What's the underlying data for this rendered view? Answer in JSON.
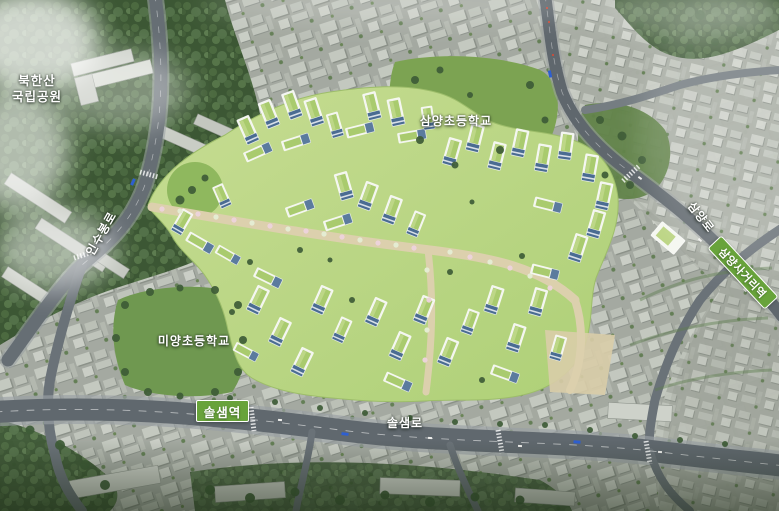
{
  "palette": {
    "label_white": "#ffffff",
    "badge_green": "#68a33b",
    "badge_border": "#ffffff",
    "road_grey": "#60686e",
    "forest_green": "#3f5a37",
    "field_green": "#7ca352",
    "city_grey": "#a9aea6",
    "dev_lawn": "#b9d383",
    "building_white": "#f3f5ef",
    "roof_green": "#a9cb6e",
    "glass_blue": "#4a6c92",
    "path_beige": "#dcd0ad",
    "bus_blue": "#2e5fd0"
  },
  "labels": {
    "park": {
      "line1": "북한산",
      "line2": "국립공원"
    },
    "samyang_school": "삼양초등학교",
    "miyang_school": "미양초등학교",
    "insubong_ro": "인수봉로",
    "samyang_ro": "삼양로",
    "solsaem_ro": "솔샘로"
  },
  "badges": {
    "solsaem_station": "솔샘역",
    "samyang_sageori_station": "삼양사거리역"
  }
}
